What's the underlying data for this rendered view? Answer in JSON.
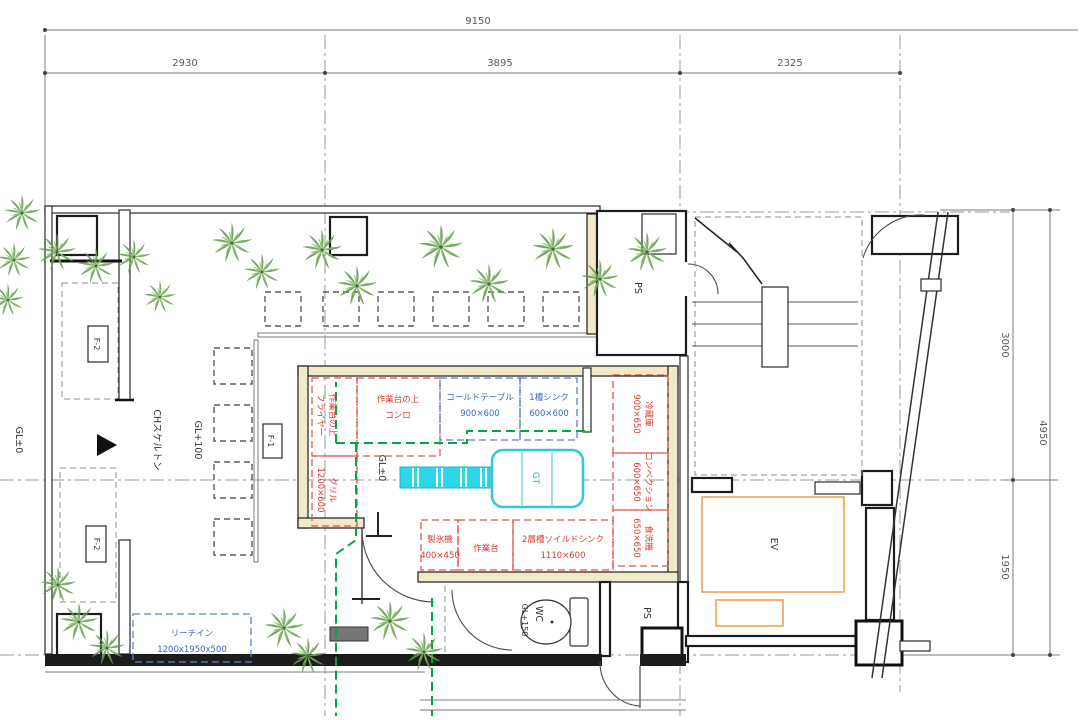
{
  "drawing": {
    "type": "restaurant-floor-plan",
    "colors": {
      "equipment_red": "#d9372b",
      "equipment_blue": "#3a66c8",
      "fixture_cyan": "#2ec9de",
      "service_green": "#00a843",
      "ev_orange": "#efa24a",
      "wall_beige": "#f2e9c9",
      "tree_green": "#5d9c49",
      "wall_black": "#1c1c1c"
    },
    "dimensions": {
      "top_total": "9150",
      "top_segments": [
        "2930",
        "3895",
        "2325"
      ],
      "right_segments": [
        "3000",
        "1950"
      ],
      "right_total": "4950"
    },
    "levels": {
      "terrace": "GL±0",
      "skeleton": "CHスケルトン",
      "floor": "GL+100",
      "kitchen": "GL±0",
      "wc": "GL+150"
    },
    "rooms": {
      "ps_top": "PS",
      "ps_bottom": "PS",
      "elevator": "EV",
      "wc": "WC"
    },
    "fixtures": {
      "f1": "F-1",
      "f2_top": "F-2",
      "f2_bottom": "F-2",
      "grease_trap": "GT"
    },
    "equipment": {
      "fryer_name": "作業台の上",
      "fryer_type": "フライヤー",
      "stove_name": "作業台の上",
      "stove_type": "コンロ",
      "cold_table_name": "コールドテーブル",
      "cold_table_size": "900×600",
      "sink1_name": "1槽シンク",
      "sink1_size": "600×600",
      "grill_name": "グリル",
      "grill_size": "1200×600",
      "fridge_name": "冷蔵庫",
      "fridge_size": "900×650",
      "convection_name": "コンベクション",
      "convection_size": "600×650",
      "dishwasher_name": "食洗機",
      "dishwasher_size": "650×650",
      "ice_maker_name": "製氷機",
      "ice_maker_size": "400×450",
      "work_table_name": "作業台",
      "soiled_sink_name": "2層槽ソイルドシンク",
      "soiled_sink_size": "1110×600",
      "reach_in_name": "リーチイン",
      "reach_in_size": "1200x1950x500"
    }
  }
}
